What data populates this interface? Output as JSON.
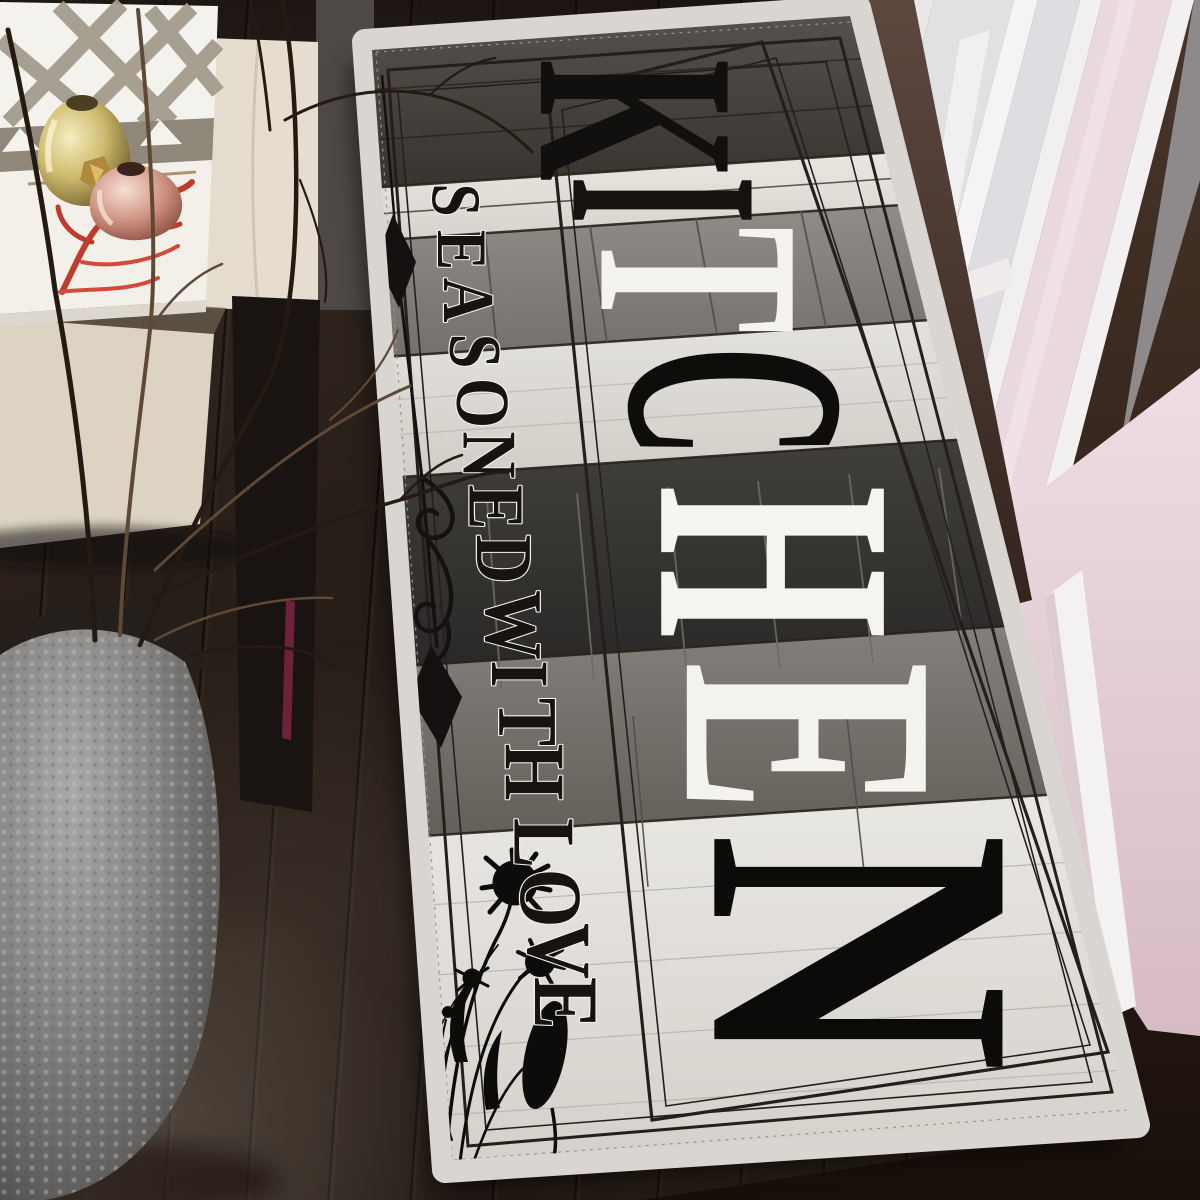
{
  "meta": {
    "kind": "lifestyle-product-photo",
    "width": 1200,
    "height": 1200
  },
  "rug": {
    "title": {
      "text": "KITCHEN",
      "letters": [
        {
          "ch": "K",
          "fill": "#12100e"
        },
        {
          "ch": "I",
          "fill": "#15120f"
        },
        {
          "ch": "T",
          "fill": "#f5f3ef"
        },
        {
          "ch": "C",
          "fill": "#0e0d0b"
        },
        {
          "ch": "H",
          "fill": "#f6f4f1"
        },
        {
          "ch": "E",
          "fill": "#f4f2ee"
        },
        {
          "ch": "N",
          "fill": "#0c0b0a"
        }
      ]
    },
    "tagline": {
      "text": "SEASONED WITH LOVE",
      "fill": "#161310",
      "outline": "#f4f3ef"
    },
    "band_colors": [
      "#4e4a46",
      "#e6e3dd",
      "#85827e",
      "#dddbd5",
      "#393735",
      "#7b7874",
      "#e2e0da"
    ],
    "binding_color": "#d9d6d1",
    "border_line_color": "#251e1e",
    "motifs": [
      "arrow-diamond-finials",
      "scroll-flourish",
      "wildflower-silhouettes"
    ]
  },
  "props": {
    "book_cover_accent": "#c13f2e",
    "tray_pattern_gray": "#a39b8d",
    "vase_gold": "#c9b96a",
    "vase_copper": "#d8a18f",
    "planter_gray": "#8f8e8c",
    "ottoman_cream": "#e3dbcb",
    "door_frame": "#f2eff0",
    "door_glass": "#e2e1e5",
    "wall_pink": "#e4cfd6",
    "wall_brown": "#4c3a33",
    "floor_brown": "#261d17"
  }
}
